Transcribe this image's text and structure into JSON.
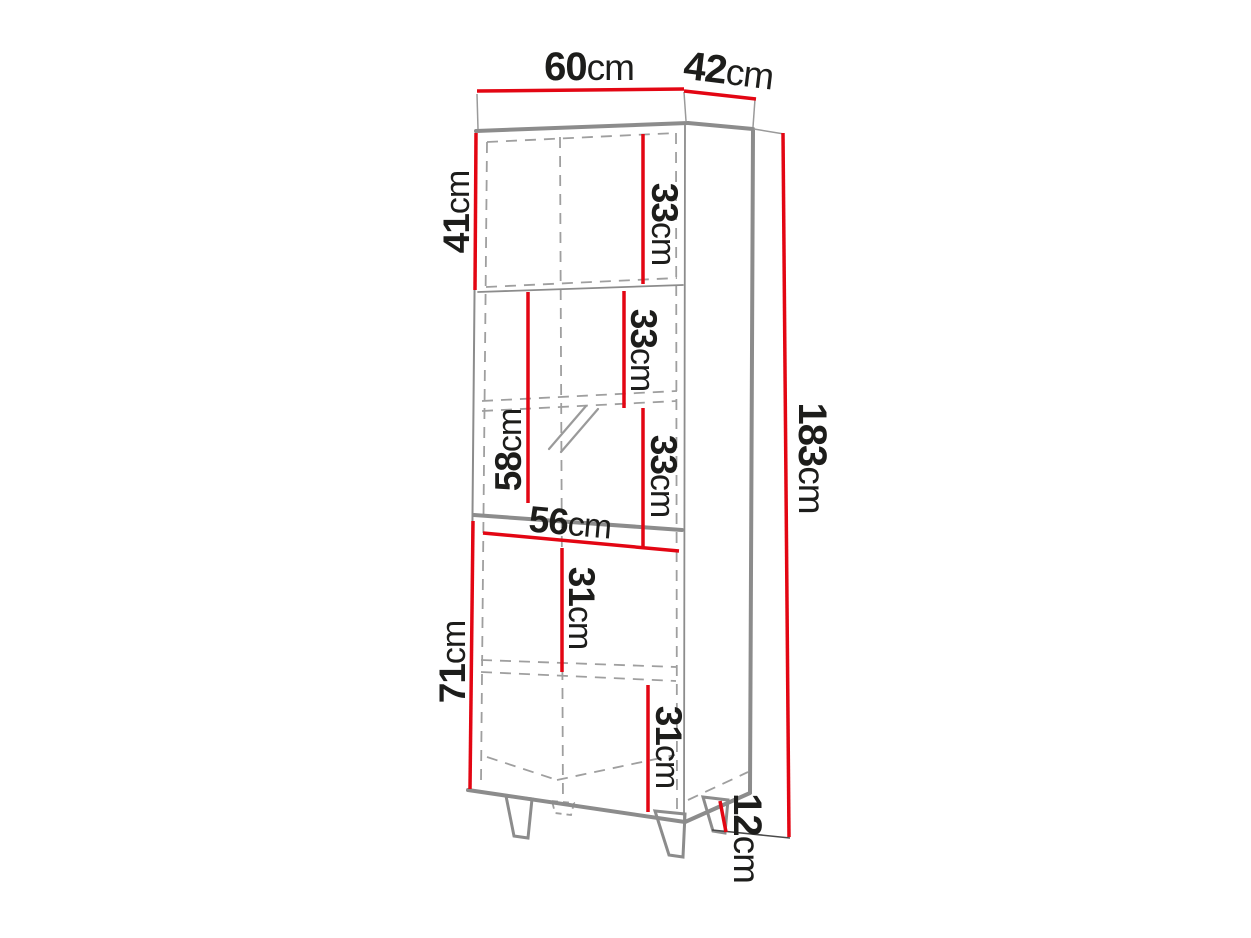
{
  "figure": {
    "kind": "cabinet-dimension-drawing",
    "unit": "cm"
  },
  "colors": {
    "dimension": "#e30613",
    "outline": "#8c8c8c",
    "dashed": "#9f9f9f",
    "text": "#1d1d1b"
  },
  "dimensions": {
    "width": {
      "num": "60",
      "unit": "cm",
      "value": 60
    },
    "depth": {
      "num": "42",
      "unit": "cm",
      "value": 42
    },
    "height": {
      "num": "183",
      "unit": "cm",
      "value": 183
    },
    "upper_section": {
      "num": "41",
      "unit": "cm",
      "value": 41
    },
    "middle_section": {
      "num": "58",
      "unit": "cm",
      "value": 58
    },
    "lower_section": {
      "num": "71",
      "unit": "cm",
      "value": 71
    },
    "upper_inner": {
      "num": "33",
      "unit": "cm",
      "value": 33
    },
    "middle_inner_upper": {
      "num": "33",
      "unit": "cm",
      "value": 33
    },
    "middle_inner_lower": {
      "num": "33",
      "unit": "cm",
      "value": 33
    },
    "inner_width": {
      "num": "56",
      "unit": "cm",
      "value": 56
    },
    "lower_inner_upper": {
      "num": "31",
      "unit": "cm",
      "value": 31
    },
    "lower_inner_lower": {
      "num": "31",
      "unit": "cm",
      "value": 31
    },
    "leg_height": {
      "num": "12",
      "unit": "cm",
      "value": 12
    }
  }
}
